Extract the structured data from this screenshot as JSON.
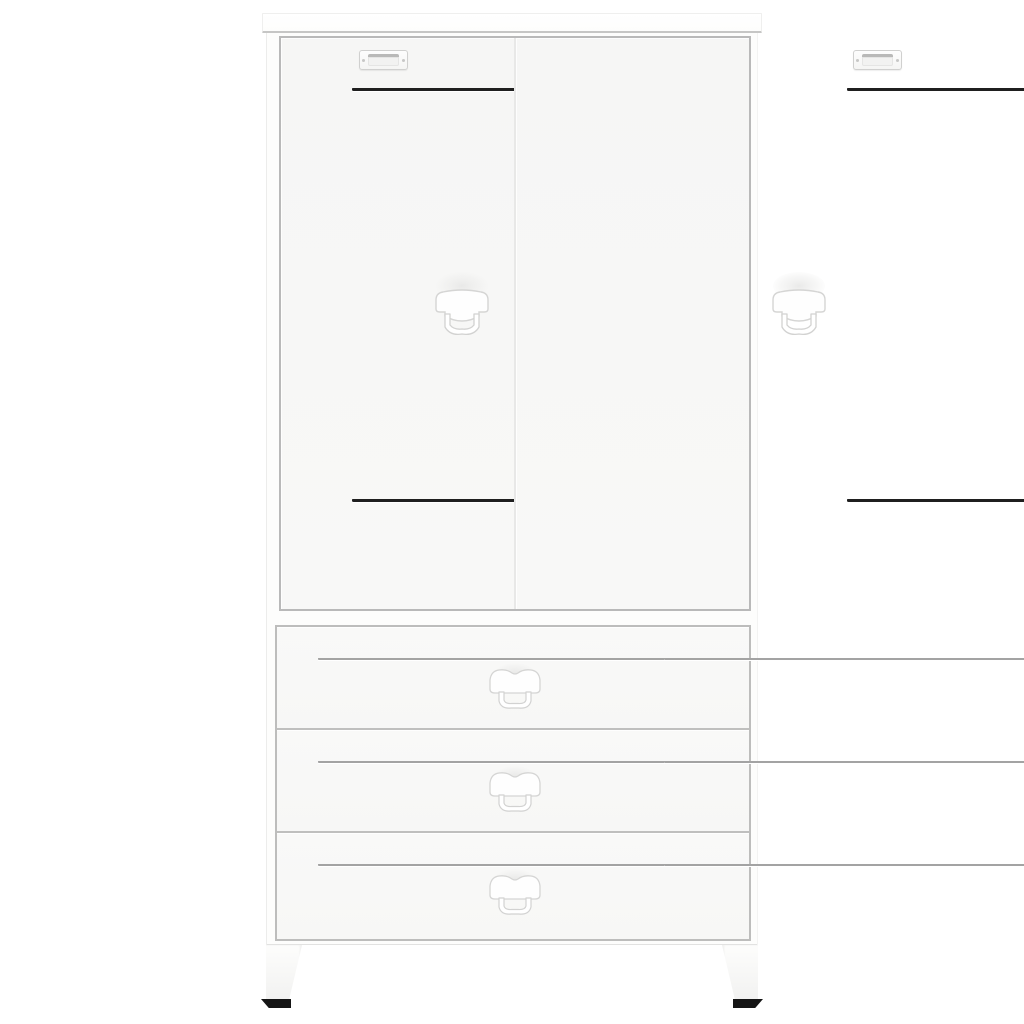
{
  "scene": {
    "description": "Product photo of a white industrial-style metal wardrobe cabinet with two vented doors above three drawers, standing on angled metal legs with black feet",
    "background_color": "#ffffff"
  },
  "colors": {
    "cabinet_white": "#ffffff",
    "panel_tint": "#f7f7f6",
    "frame_line": "#b9b9b9",
    "seam_light": "#e8e8e7",
    "vent_slot_dark": "#1f1f1f",
    "vent_slot_gray": "#a3a3a3",
    "handle_outline": "#d6d6d5",
    "foot_black": "#151515"
  },
  "structure": {
    "door_count": 2,
    "drawer_count": 3,
    "label_holder_count": 2,
    "door_handle_count": 2,
    "drawer_handle_count": 3,
    "door_vent_group_count": 4,
    "drawer_vent_group_count": 6,
    "door_vent_slat_count": 5,
    "drawer_vent_slat_count": 5,
    "leg_count": 2
  }
}
